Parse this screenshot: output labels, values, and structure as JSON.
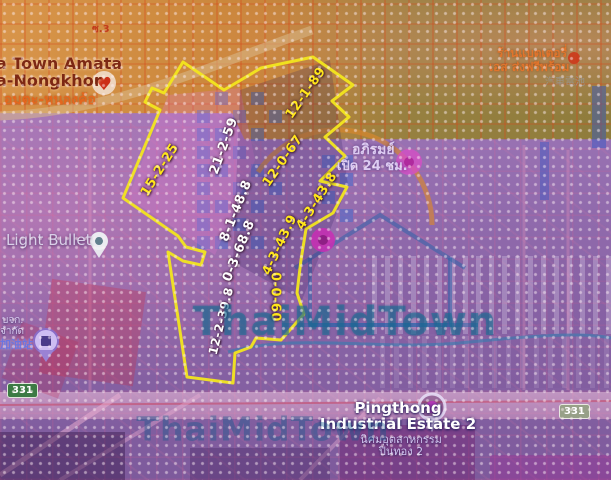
{
  "watermark": {
    "text": "ThaiMidTown"
  },
  "parcels": [
    {
      "label": "15-2-25",
      "color": "yellow"
    },
    {
      "label": "21-2-59",
      "color": "white"
    },
    {
      "label": "12-1-89",
      "color": "yellow"
    },
    {
      "label": "12-0-67",
      "color": "yellow"
    },
    {
      "label": "8-1-48.8",
      "color": "white"
    },
    {
      "label": "0-3-68.8",
      "color": "white"
    },
    {
      "label": "4-3-43.9",
      "color": "yellow"
    },
    {
      "label": "4-3-43.8",
      "color": "yellow"
    },
    {
      "label": "0-0-60",
      "color": "yellow"
    },
    {
      "label": "12-2-39.8",
      "color": "white"
    }
  ],
  "places": {
    "town_line1": "a Town Amata",
    "town_line2": "a-Nongkhor",
    "town_thai": "อมตะ-หนองค้อ",
    "soi": "ซ.3",
    "battery_line1": "ร้านแบตเตอรี่",
    "battery_line2": "เอส ส่งฟรีพร้อม",
    "battery_line3": "汽車電池",
    "open24_line1": "อภิรมย์",
    "open24_line2": "เปิด 24 ชม.",
    "light_bullet": "Light Bullet",
    "gas_line1": "บจก.",
    "gas_line2": "จำกัด",
    "gas_line3": "加油站",
    "pingthong_line1": "Pingthong",
    "pingthong_line2": "Industrial Estate 2",
    "pingthong_thai1": "นิคมอุตสาหกรรม",
    "pingthong_thai2": "ปิ่นทอง 2",
    "route_331_left": "331",
    "route_331_right": "331"
  },
  "colors": {
    "boundary_yellow": "#f2e61e",
    "parcel_label_yellow": "#ffe619",
    "parcel_label_white": "#ffffff",
    "watermark_teal": "#1e739b",
    "orange_zone": "#c9853a",
    "olive_zone": "#8f7c3c",
    "purple_zone": "#8f6cae",
    "road_pink": "#e8b7d2",
    "route_shield_green": "#3c7a44"
  }
}
